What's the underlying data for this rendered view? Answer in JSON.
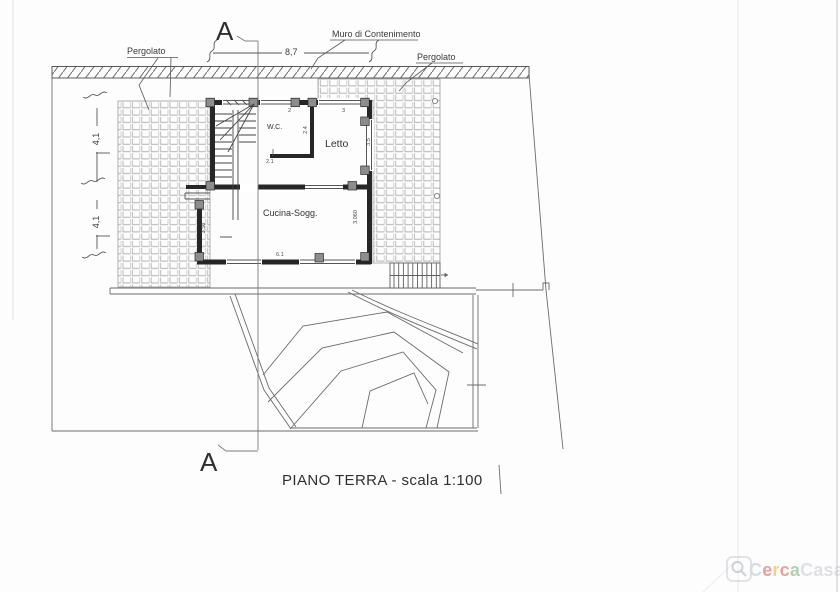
{
  "drawing": {
    "title": "PIANO TERRA - scala 1:100",
    "section_label": "A",
    "annotations": {
      "pergolato_left": "Pergolato",
      "muro_di_contenimento": "Muro di Contenimento",
      "pergolato_right": "Pergolato"
    },
    "rooms": {
      "wc": "W.C.",
      "letto": "Letto",
      "cucina_sogg": "Cucina-Sogg."
    },
    "dimensions": {
      "top_width": "8,7",
      "left_upper": "4,1",
      "left_lower": "4,1",
      "wc_window": "2",
      "letto_window": "3",
      "wc_depth": "2.4",
      "letto_depth": "3.5",
      "wc_door": "2.1",
      "cucina_left": "3.50",
      "cucina_right": "3.060",
      "cucina_width": "6.1"
    }
  },
  "watermark": {
    "name": "CercaCasa",
    "letters": [
      {
        "ch": "C",
        "color": "#b6c0d2"
      },
      {
        "ch": "e",
        "color": "#d5574d"
      },
      {
        "ch": "r",
        "color": "#e9ae3a"
      },
      {
        "ch": "c",
        "color": "#d5574d"
      },
      {
        "ch": "a",
        "color": "#76aa74"
      },
      {
        "ch": "C",
        "color": "#c5c9d1"
      },
      {
        "ch": "a",
        "color": "#c5c9d1"
      },
      {
        "ch": "s",
        "color": "#c5c9d1"
      },
      {
        "ch": "a",
        "color": "#c5c9d1"
      }
    ]
  },
  "colors": {
    "wall": "#262626",
    "tile_grid": "#b1b1b1",
    "paper": "#fdfdfd"
  }
}
